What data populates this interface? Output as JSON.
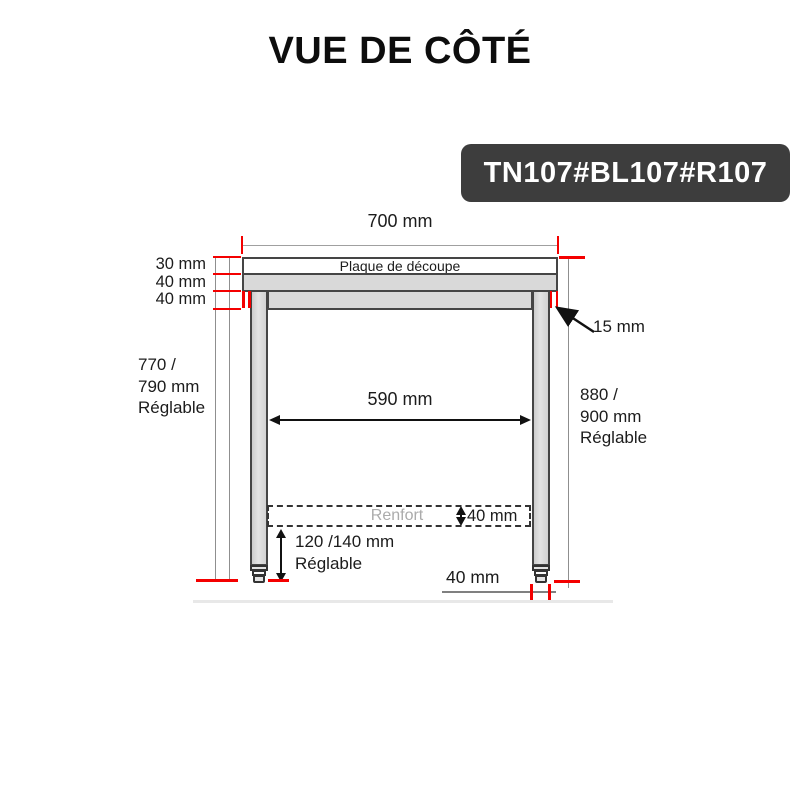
{
  "title": "VUE DE CÔTÉ",
  "product_code": "TN107#BL107#R107",
  "colors": {
    "accent_red": "#f40000",
    "outline_dark": "#454545",
    "fill_gray": "#d9d9d9",
    "dim_line_gray": "#8f8f8f",
    "badge_bg": "#3d3d3d",
    "badge_text": "#ffffff",
    "brace_text": "#ababab"
  },
  "labels": {
    "top_width": "700 mm",
    "cutting_plate": "Plaque de découpe",
    "plate_thickness": "30 mm",
    "top_thickness": "40 mm",
    "apron_height": "40 mm",
    "left_height": {
      "line1": "770 /",
      "line2": "790 mm",
      "line3": "Réglable"
    },
    "right_height": {
      "line1": "880 /",
      "line2": "900 mm",
      "line3": "Réglable"
    },
    "edge_offset": "15 mm",
    "inner_width": "590 mm",
    "brace": "Renfort",
    "brace_height": "40 mm",
    "foot_adjust": {
      "line1": "120 /140 mm",
      "line2": "Réglable"
    },
    "foot_width": "40 mm"
  }
}
